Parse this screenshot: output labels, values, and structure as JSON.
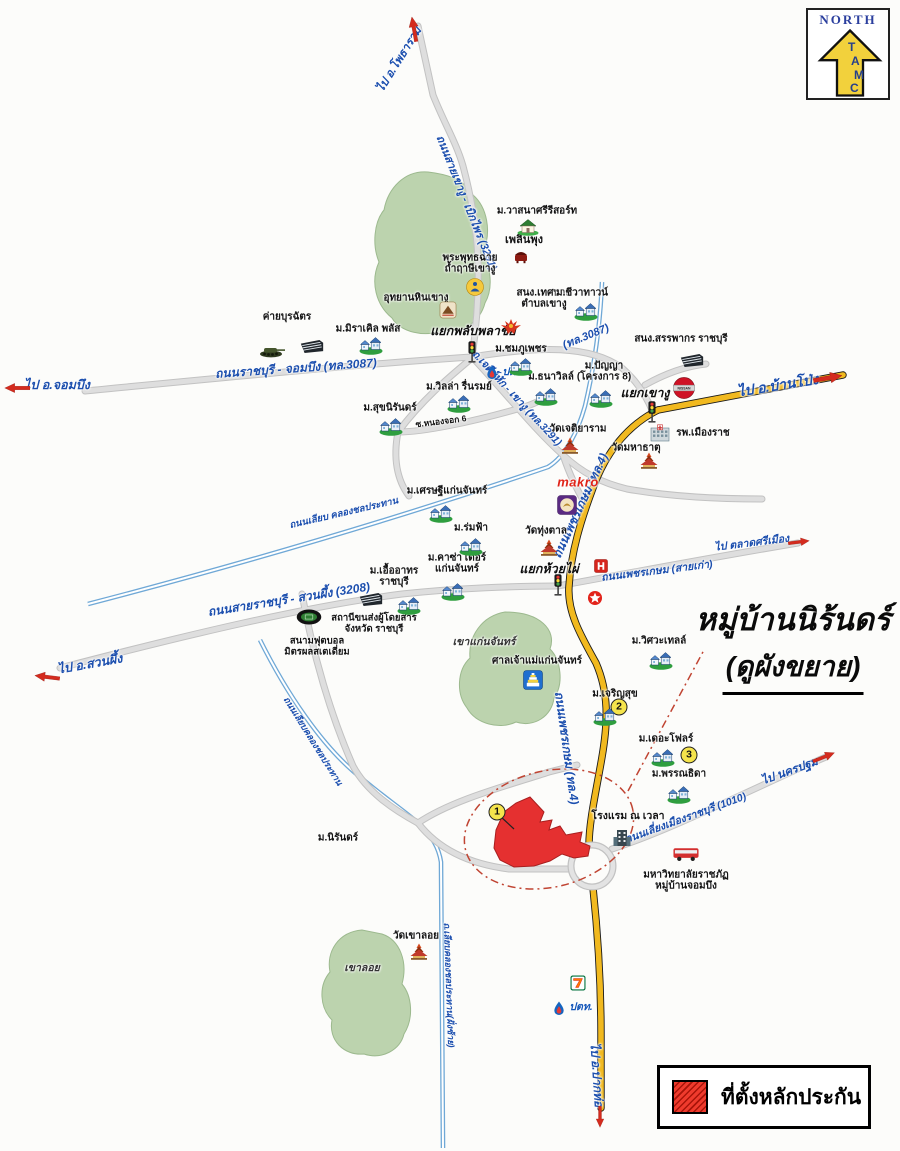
{
  "compass": {
    "north": "NORTH",
    "letters": [
      "T",
      "A",
      "M",
      "C"
    ]
  },
  "callout": {
    "line1": "หมู่บ้านนิร้นดร์",
    "line2": "(ดูผังขยาย)"
  },
  "legend": {
    "label": "ที่ตั้งหลักประกัน"
  },
  "colors": {
    "road_yellow": "#f1b91f",
    "road_gray": "#dedede",
    "canal_blue": "#6fa8d6",
    "hill_green": "#bcd3ae",
    "collateral_red": "#e53030",
    "label_blue": "#1c4fae",
    "arrow_red": "#d42b1e",
    "badge_yellow": "#f5e44c"
  },
  "map": {
    "labels": [
      {
        "id": "road-label-3087",
        "t": [
          "ถนนราชบุรี - จอมบึง (ทล.3087)"
        ],
        "x": 296,
        "y": 369,
        "r": -4,
        "c": "road",
        "s": 12
      },
      {
        "id": "road-label-3087-2",
        "t": [
          "(ทล.3087)"
        ],
        "x": 586,
        "y": 337,
        "r": -22,
        "c": "road",
        "s": 11
      },
      {
        "id": "road-label-3291",
        "t": [
          "ถนนสายเขางู - เบิกไพร (3291)"
        ],
        "x": 466,
        "y": 203,
        "r": 68,
        "c": "road",
        "s": 11
      },
      {
        "id": "road-label-jedi-hak",
        "t": [
          "ถ.เจดีย์หัก - เขางู (ทล.3291)"
        ],
        "x": 516,
        "y": 399,
        "r": 47,
        "c": "road",
        "s": 10.5
      },
      {
        "id": "road-label-phet-old",
        "t": [
          "ถนนเพชรเกษม (สายเก่า)"
        ],
        "x": 657,
        "y": 572,
        "r": -7,
        "c": "road",
        "s": 10.5
      },
      {
        "id": "road-label-phet4-north",
        "t": [
          "ถนนเพชรเกษม (ทล.4)"
        ],
        "x": 581,
        "y": 506,
        "r": -65,
        "c": "road",
        "s": 12
      },
      {
        "id": "road-label-phet4-south",
        "t": [
          "ถนนเพชรเกษม (ทล.4)"
        ],
        "x": 566,
        "y": 748,
        "r": 82,
        "c": "road",
        "s": 12
      },
      {
        "id": "road-label-3208",
        "t": [
          "ถนนสายราชบุรี - สวนผึ้ง (3208)"
        ],
        "x": 289,
        "y": 600,
        "r": -9,
        "c": "road",
        "s": 12
      },
      {
        "id": "road-label-1010",
        "t": [
          "ถนนเลี่ยงเมืองราชบุรี (1010)"
        ],
        "x": 686,
        "y": 819,
        "r": -20,
        "c": "road",
        "s": 10.5
      },
      {
        "id": "canal-label-1",
        "t": [
          "ถนนเลียบ คลองชลประทาน"
        ],
        "x": 344,
        "y": 514,
        "r": -13,
        "c": "road",
        "s": 9.5
      },
      {
        "id": "canal-label-2",
        "t": [
          "ถนนเลียบคลองชลประทาน"
        ],
        "x": 313,
        "y": 741,
        "r": 58,
        "c": "road",
        "s": 9
      },
      {
        "id": "canal-label-3",
        "t": [
          "ถ.เลียบคลองชลประทาน(ฝั่งซ้าย)"
        ],
        "x": 449,
        "y": 985,
        "r": 88,
        "c": "road",
        "s": 9
      },
      {
        "id": "dir-chom-bueng",
        "t": [
          "ไป อ.จอมบึง"
        ],
        "x": 57,
        "y": 385,
        "r": 0,
        "c": "dir",
        "s": 12.5
      },
      {
        "id": "dir-photharam",
        "t": [
          "ไป อ.โพธาราม"
        ],
        "x": 400,
        "y": 60,
        "r": -58,
        "c": "dir",
        "s": 11.5
      },
      {
        "id": "dir-ban-pong",
        "t": [
          "ไป อ.บ้านโป่ง"
        ],
        "x": 778,
        "y": 386,
        "r": -9,
        "c": "dir",
        "s": 14
      },
      {
        "id": "dir-srimuang-market",
        "t": [
          "ไป ตลาดศรีเมือง"
        ],
        "x": 752,
        "y": 544,
        "r": -7,
        "c": "dir",
        "s": 10.5
      },
      {
        "id": "dir-suan-phueng",
        "t": [
          "ไป อ.สวนผึ้ง"
        ],
        "x": 90,
        "y": 664,
        "r": -10,
        "c": "dir",
        "s": 12.5
      },
      {
        "id": "dir-nakhon-pathom",
        "t": [
          "ไป นครปฐม"
        ],
        "x": 790,
        "y": 772,
        "r": -20,
        "c": "dir",
        "s": 11.5
      },
      {
        "id": "dir-pak-tho",
        "t": [
          "ไป อ.ปากท่อ"
        ],
        "x": 596,
        "y": 1075,
        "r": 86,
        "c": "dir",
        "s": 12
      },
      {
        "id": "junction-plubplachai",
        "t": [
          "แยกพลับพลาชัย"
        ],
        "x": 473,
        "y": 331,
        "c": "junction"
      },
      {
        "id": "junction-khao-ngu",
        "t": [
          "แยกเขางู"
        ],
        "x": 645,
        "y": 393,
        "c": "junction"
      },
      {
        "id": "junction-huai-phai",
        "t": [
          "แยกห้วยไผ่"
        ],
        "x": 549,
        "y": 569,
        "c": "junction"
      },
      {
        "id": "area-khao-kaen-chan",
        "t": [
          "เขาแก่นจันทร์"
        ],
        "x": 484,
        "y": 643,
        "c": "area",
        "s": 10.5
      },
      {
        "id": "area-khao-loi",
        "t": [
          "เขาลอย"
        ],
        "x": 362,
        "y": 969,
        "c": "area",
        "s": 10.5
      },
      {
        "id": "place-wasana-resort",
        "t": [
          "ม.วาสนาศรีรีสอร์ท"
        ],
        "x": 537,
        "y": 211,
        "c": "place"
      },
      {
        "id": "place-ploen-phung",
        "t": [
          "เพลินพุง"
        ],
        "x": 524,
        "y": 240,
        "c": "place",
        "s": 11
      },
      {
        "id": "place-phra-phuttha-chai",
        "t": [
          "พระพุทธฉาย",
          "ถ้ำฤาษีเขางู"
        ],
        "x": 470,
        "y": 264,
        "c": "place"
      },
      {
        "id": "place-uthayan-hin-khao-ngu",
        "t": [
          "อุทยานหินเขางู"
        ],
        "x": 416,
        "y": 298,
        "c": "place"
      },
      {
        "id": "place-thesaban-khao-ngu",
        "t": [
          "สนง.เทศบาล",
          "ตำบลเขางู"
        ],
        "x": 544,
        "y": 299,
        "c": "place"
      },
      {
        "id": "place-chiwa-town",
        "t": [
          "ม.ชีวาทาวน์"
        ],
        "x": 582,
        "y": 293,
        "c": "place"
      },
      {
        "id": "place-miracle-plus",
        "t": [
          "ม.มิราเคิล พลัส"
        ],
        "x": 368,
        "y": 329,
        "c": "place"
      },
      {
        "id": "place-khai-burachat",
        "t": [
          "ค่ายบุรฉัตร"
        ],
        "x": 287,
        "y": 317,
        "c": "place"
      },
      {
        "id": "place-chomphu-phet",
        "t": [
          "ม.ชมภูเพชร"
        ],
        "x": 521,
        "y": 349,
        "c": "place"
      },
      {
        "id": "place-thanawill",
        "t": [
          "ม.ธนาวิลล์"
        ],
        "x": 551,
        "y": 377,
        "c": "place"
      },
      {
        "id": "place-panya",
        "t": [
          "ม.ปัญญา",
          "(โครงการ 8)"
        ],
        "x": 604,
        "y": 372,
        "c": "place"
      },
      {
        "id": "place-villa-ruenrom",
        "t": [
          "ม.วิลล่า รื่นรมย์"
        ],
        "x": 459,
        "y": 387,
        "c": "place"
      },
      {
        "id": "place-suk-niran",
        "t": [
          "ม.สุขนิรันดร์"
        ],
        "x": 390,
        "y": 408,
        "c": "place"
      },
      {
        "id": "place-soi-nong-chok",
        "t": [
          "ซ.หนองจอก 6"
        ],
        "x": 441,
        "y": 422,
        "r": -7,
        "c": "place",
        "s": 8.5
      },
      {
        "id": "place-sanphakon",
        "t": [
          "สนง.สรรพากร ราชบุรี"
        ],
        "x": 681,
        "y": 339,
        "c": "place"
      },
      {
        "id": "place-mueang-rat-hospital",
        "t": [
          "รพ.เมืองราช"
        ],
        "x": 703,
        "y": 433,
        "c": "place"
      },
      {
        "id": "place-wat-mahathat",
        "t": [
          "วัดมหาธาตุ"
        ],
        "x": 636,
        "y": 448,
        "c": "place"
      },
      {
        "id": "place-wat-chetiyaram",
        "t": [
          "วัดเจติยาราม"
        ],
        "x": 578,
        "y": 429,
        "c": "place"
      },
      {
        "id": "place-setthi-kaen-chan",
        "t": [
          "ม.เศรษฐีแก่นจันทร์"
        ],
        "x": 447,
        "y": 491,
        "c": "place"
      },
      {
        "id": "place-rom-fa",
        "t": [
          "ม.ร่มฟ้า"
        ],
        "x": 471,
        "y": 528,
        "c": "place"
      },
      {
        "id": "place-casa-kaen-chan",
        "t": [
          "ม.คาซ่า เดอร์",
          "แก่นจันทร์"
        ],
        "x": 457,
        "y": 564,
        "c": "place"
      },
      {
        "id": "place-uea-athon",
        "t": [
          "ม.เอื้ออาทร",
          "ราชบุรี"
        ],
        "x": 394,
        "y": 577,
        "c": "place"
      },
      {
        "id": "place-wat-thung-tan",
        "t": [
          "วัดทุ่งตาล"
        ],
        "x": 546,
        "y": 531,
        "c": "place"
      },
      {
        "id": "place-san-chao-mae",
        "t": [
          "ศาลเจ้าแม่แก่นจันทร์"
        ],
        "x": 537,
        "y": 661,
        "c": "place"
      },
      {
        "id": "place-witsawa-thel",
        "t": [
          "ม.วิศวะเทลล์"
        ],
        "x": 659,
        "y": 641,
        "c": "place"
      },
      {
        "id": "place-charoen-suk",
        "t": [
          "ม.เจริญสุข"
        ],
        "x": 615,
        "y": 694,
        "c": "place"
      },
      {
        "id": "place-the-flor",
        "t": [
          "ม.เดอะโฟลร์"
        ],
        "x": 666,
        "y": 739,
        "c": "place"
      },
      {
        "id": "place-phan-thida",
        "t": [
          "ม.พรรณธิดา"
        ],
        "x": 679,
        "y": 774,
        "c": "place"
      },
      {
        "id": "place-niran",
        "t": [
          "ม.นิรันดร์"
        ],
        "x": 338,
        "y": 838,
        "c": "place"
      },
      {
        "id": "place-na-vela-hotel",
        "t": [
          "โรงแรม ณ เวลา"
        ],
        "x": 628,
        "y": 817,
        "c": "place",
        "s": 10.5
      },
      {
        "id": "place-ratchaphat",
        "t": [
          "มหาวิทยาลัยราชภัฏ",
          "หมู่บ้านจอมบึง"
        ],
        "x": 686,
        "y": 881,
        "c": "place"
      },
      {
        "id": "place-wat-khao-loi",
        "t": [
          "วัดเขาลอย"
        ],
        "x": 416,
        "y": 936,
        "c": "place"
      },
      {
        "id": "place-mitr-phol-stadium",
        "t": [
          "สนามฟุตบอล",
          "มิตรผลสเตเดี่ยม"
        ],
        "x": 317,
        "y": 647,
        "c": "place",
        "s": 9.5
      },
      {
        "id": "place-bus-terminal",
        "t": [
          "สถานีขนส่งผู้โดยสาร",
          "จังหวัด ราชบุรี"
        ],
        "x": 374,
        "y": 624,
        "c": "place",
        "s": 9.5
      },
      {
        "id": "brand-makro",
        "t": [
          "makro"
        ],
        "x": 578,
        "y": 483,
        "c": "brand-makro",
        "s": 13
      },
      {
        "id": "brand-ptt-north",
        "t": [
          "ปตท."
        ],
        "x": 514,
        "y": 373,
        "c": "brand-ptt",
        "s": 10.5
      },
      {
        "id": "brand-ptt-south",
        "t": [
          "ปตท."
        ],
        "x": 581,
        "y": 1008,
        "c": "brand-ptt",
        "s": 10.5
      },
      {
        "id": "badge-1",
        "t": [
          "1"
        ],
        "x": 497,
        "y": 812,
        "c": "badge"
      },
      {
        "id": "badge-2",
        "t": [
          "2"
        ],
        "x": 619,
        "y": 707,
        "c": "badge"
      },
      {
        "id": "badge-3",
        "t": [
          "3"
        ],
        "x": 689,
        "y": 755,
        "c": "badge"
      }
    ],
    "icons": [
      {
        "id": "traffic-light-icon-plubplachai",
        "sym": "traffic-light",
        "x": 472,
        "y": 352,
        "w": 11,
        "h": 22
      },
      {
        "id": "traffic-light-icon-khao-ngu",
        "sym": "traffic-light",
        "x": 652,
        "y": 412,
        "w": 11,
        "h": 22
      },
      {
        "id": "traffic-light-icon-huai-phai",
        "sym": "traffic-light",
        "x": 558,
        "y": 585,
        "w": 11,
        "h": 22
      },
      {
        "id": "village-icon-chiwa-town",
        "sym": "village",
        "x": 586,
        "y": 311,
        "w": 24,
        "h": 20
      },
      {
        "id": "village-icon-miracle-plus",
        "sym": "village",
        "x": 371,
        "y": 345,
        "w": 24,
        "h": 20
      },
      {
        "id": "village-icon-chomphu-phet",
        "sym": "village",
        "x": 521,
        "y": 366,
        "w": 24,
        "h": 20
      },
      {
        "id": "village-icon-thanawill",
        "sym": "village",
        "x": 546,
        "y": 396,
        "w": 24,
        "h": 20
      },
      {
        "id": "village-icon-panya",
        "sym": "village",
        "x": 601,
        "y": 398,
        "w": 24,
        "h": 20
      },
      {
        "id": "village-icon-villa-ruenrom",
        "sym": "village",
        "x": 459,
        "y": 403,
        "w": 24,
        "h": 20
      },
      {
        "id": "village-icon-suk-niran",
        "sym": "village",
        "x": 391,
        "y": 426,
        "w": 24,
        "h": 20
      },
      {
        "id": "village-icon-setthi",
        "sym": "village",
        "x": 441,
        "y": 513,
        "w": 24,
        "h": 20
      },
      {
        "id": "village-icon-rom-fa",
        "sym": "village",
        "x": 471,
        "y": 546,
        "w": 24,
        "h": 20
      },
      {
        "id": "village-icon-casa",
        "sym": "village",
        "x": 453,
        "y": 591,
        "w": 24,
        "h": 20
      },
      {
        "id": "village-icon-uea-athon",
        "sym": "village",
        "x": 409,
        "y": 605,
        "w": 24,
        "h": 20
      },
      {
        "id": "village-icon-witsawa",
        "sym": "village",
        "x": 661,
        "y": 660,
        "w": 24,
        "h": 20
      },
      {
        "id": "village-icon-charoen-suk",
        "sym": "village",
        "x": 605,
        "y": 716,
        "w": 24,
        "h": 20
      },
      {
        "id": "village-icon-the-flor",
        "sym": "village",
        "x": 663,
        "y": 757,
        "w": 24,
        "h": 20
      },
      {
        "id": "village-icon-phan-thida",
        "sym": "village",
        "x": 679,
        "y": 794,
        "w": 24,
        "h": 20
      },
      {
        "id": "temple-icon-chetiyaram",
        "sym": "temple",
        "x": 570,
        "y": 446,
        "w": 24,
        "h": 18
      },
      {
        "id": "temple-icon-mahathat",
        "sym": "temple",
        "x": 649,
        "y": 461,
        "w": 24,
        "h": 18
      },
      {
        "id": "temple-icon-thung-tan",
        "sym": "temple",
        "x": 549,
        "y": 548,
        "w": 24,
        "h": 18
      },
      {
        "id": "temple-icon-khao-loi",
        "sym": "temple",
        "x": 419,
        "y": 952,
        "w": 24,
        "h": 18
      },
      {
        "id": "house-icon-wasana",
        "sym": "house",
        "x": 528,
        "y": 227,
        "w": 22,
        "h": 18
      },
      {
        "id": "restaurant-icon-ploen-phung",
        "sym": "rest",
        "x": 521,
        "y": 257,
        "w": 14,
        "h": 14
      },
      {
        "id": "buddha-icon",
        "sym": "buddha",
        "x": 475,
        "y": 287,
        "w": 18,
        "h": 18
      },
      {
        "id": "mountain-park-icon",
        "sym": "mountain",
        "x": 448,
        "y": 310,
        "w": 17,
        "h": 17
      },
      {
        "id": "garuda-icon",
        "sym": "garuda",
        "x": 511,
        "y": 327,
        "w": 22,
        "h": 18
      },
      {
        "id": "building-icon-burachat",
        "sym": "bldg",
        "x": 312,
        "y": 346,
        "w": 26,
        "h": 16
      },
      {
        "id": "building-icon-sanphakon",
        "sym": "bldg",
        "x": 692,
        "y": 360,
        "w": 26,
        "h": 16
      },
      {
        "id": "building-icon-bus-terminal",
        "sym": "bldg",
        "x": 371,
        "y": 599,
        "w": 26,
        "h": 16
      },
      {
        "id": "tank-icon",
        "sym": "tank",
        "x": 272,
        "y": 350,
        "w": 28,
        "h": 15
      },
      {
        "id": "stadium-icon",
        "sym": "stadium",
        "x": 309,
        "y": 617,
        "w": 27,
        "h": 17
      },
      {
        "id": "ptt-icon-north",
        "sym": "ptt",
        "x": 492,
        "y": 372,
        "w": 13,
        "h": 15
      },
      {
        "id": "ptt-icon-south",
        "sym": "ptt",
        "x": 559,
        "y": 1008,
        "w": 13,
        "h": 15
      },
      {
        "id": "makro-logo-icon",
        "sym": "makro-logo",
        "x": 567,
        "y": 505,
        "w": 20,
        "h": 20
      },
      {
        "id": "nissan-logo-icon",
        "sym": "nissan",
        "x": 684,
        "y": 388,
        "w": 23,
        "h": 23
      },
      {
        "id": "honda-logo-icon",
        "sym": "honda",
        "x": 601,
        "y": 566,
        "w": 14,
        "h": 14
      },
      {
        "id": "caltex-logo-icon",
        "sym": "caltex",
        "x": 595,
        "y": 598,
        "w": 15,
        "h": 15
      },
      {
        "id": "hospital-icon",
        "sym": "hospital",
        "x": 660,
        "y": 433,
        "w": 20,
        "h": 18
      },
      {
        "id": "shrine-icon",
        "sym": "shrine",
        "x": 533,
        "y": 680,
        "w": 20,
        "h": 20
      },
      {
        "id": "hotel-icon",
        "sym": "hotel",
        "x": 622,
        "y": 838,
        "w": 20,
        "h": 18
      },
      {
        "id": "bus-icon-university",
        "sym": "bus",
        "x": 686,
        "y": 854,
        "w": 27,
        "h": 16
      },
      {
        "id": "seven-eleven-icon",
        "sym": "seven",
        "x": 578,
        "y": 983,
        "w": 15,
        "h": 15
      },
      {
        "id": "arrow-icon-chom-bueng",
        "sym": "arrow",
        "x": 17,
        "y": 388,
        "w": 26,
        "h": 10,
        "r": 180
      },
      {
        "id": "arrow-icon-photharam",
        "sym": "arrow",
        "x": 414,
        "y": 29,
        "w": 26,
        "h": 10,
        "r": -100
      },
      {
        "id": "arrow-icon-ban-pong",
        "sym": "arrow",
        "x": 828,
        "y": 378,
        "w": 30,
        "h": 12,
        "r": -10
      },
      {
        "id": "arrow-icon-srimuang",
        "sym": "arrow",
        "x": 799,
        "y": 542,
        "w": 22,
        "h": 9,
        "r": -7
      },
      {
        "id": "arrow-icon-suan-phueng",
        "sym": "arrow",
        "x": 47,
        "y": 677,
        "w": 26,
        "h": 10,
        "r": 187
      },
      {
        "id": "arrow-icon-nakhon-pathom",
        "sym": "arrow",
        "x": 824,
        "y": 757,
        "w": 24,
        "h": 10,
        "r": -22
      },
      {
        "id": "arrow-icon-pak-tho",
        "sym": "arrow",
        "x": 600,
        "y": 1117,
        "w": 22,
        "h": 9,
        "r": 90
      }
    ]
  }
}
